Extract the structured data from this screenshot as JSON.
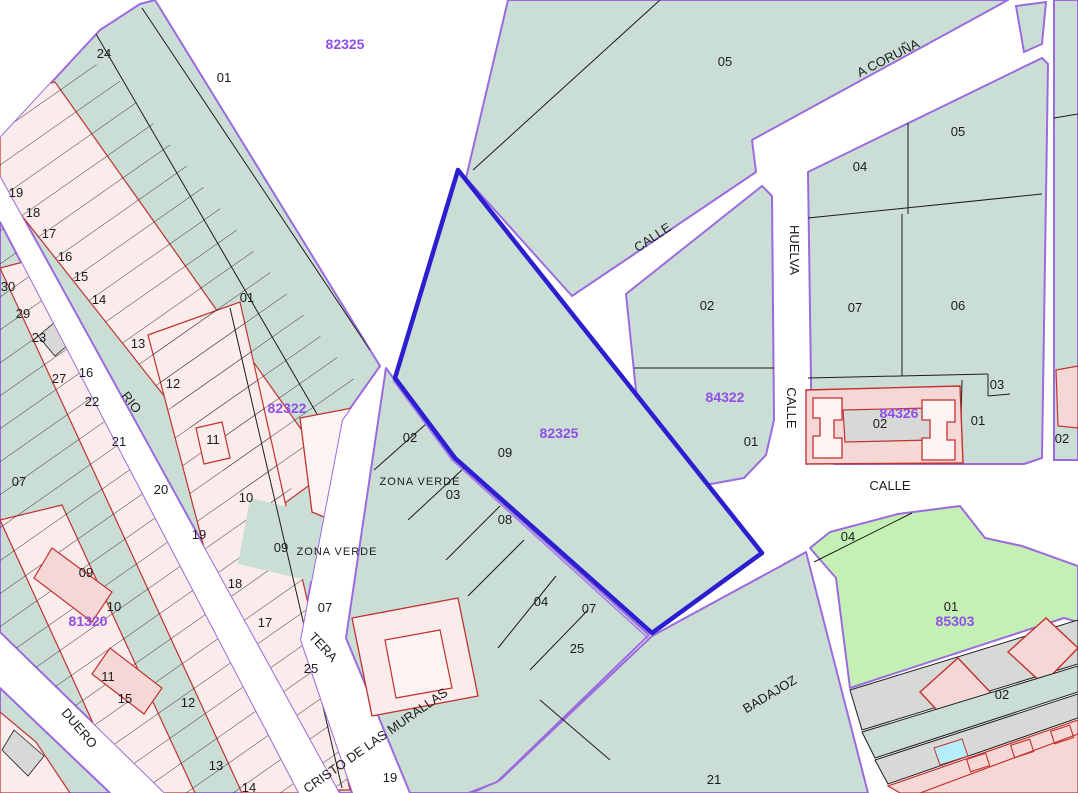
{
  "title": "Cadastral map viewer",
  "colors": {
    "street_white": "#ffffff",
    "parcel_green": "#cbded6",
    "zone_light_green": "#c5f0b5",
    "rowhouse_pink": "#faecea",
    "building_pink": "#f5d8d5",
    "courtyard_gray": "#d6d9d6",
    "pool_cyan": "#b5eefa",
    "block_border_purple": "#9b6bde",
    "selected_parcel_blue": "#2b1fd0",
    "building_red": "#c23230",
    "parcel_line_black": "#1c1c1c",
    "block_number_purple": "#8f4fe8"
  },
  "map": {
    "selected_block_number": "82325",
    "labels": [
      {
        "t": "24",
        "x": 104,
        "y": 58,
        "k": "k"
      },
      {
        "t": "01",
        "x": 224,
        "y": 82,
        "k": "k"
      },
      {
        "t": "82325",
        "x": 345,
        "y": 49,
        "k": "p"
      },
      {
        "t": "05",
        "x": 725,
        "y": 66,
        "k": "k"
      },
      {
        "t": "A CORUÑA",
        "x": 890,
        "y": 62,
        "k": "s",
        "r": -27
      },
      {
        "t": "05",
        "x": 958,
        "y": 136,
        "k": "k"
      },
      {
        "t": "04",
        "x": 860,
        "y": 171,
        "k": "k"
      },
      {
        "t": "CALLE",
        "x": 655,
        "y": 241,
        "k": "s",
        "r": -34
      },
      {
        "t": "HUELVA",
        "x": 790,
        "y": 250,
        "k": "s",
        "r": 90
      },
      {
        "t": "02",
        "x": 707,
        "y": 310,
        "k": "k"
      },
      {
        "t": "07",
        "x": 855,
        "y": 312,
        "k": "k"
      },
      {
        "t": "06",
        "x": 958,
        "y": 310,
        "k": "k"
      },
      {
        "t": "01",
        "x": 247,
        "y": 302,
        "k": "k"
      },
      {
        "t": "82322",
        "x": 287,
        "y": 413,
        "k": "p"
      },
      {
        "t": "84322",
        "x": 725,
        "y": 402,
        "k": "p"
      },
      {
        "t": "CALLE",
        "x": 787,
        "y": 408,
        "k": "s",
        "r": 90
      },
      {
        "t": "84326",
        "x": 899,
        "y": 418,
        "k": "p"
      },
      {
        "t": "02",
        "x": 880,
        "y": 428,
        "k": "k"
      },
      {
        "t": "01",
        "x": 978,
        "y": 425,
        "k": "k"
      },
      {
        "t": "03",
        "x": 997,
        "y": 389,
        "k": "k"
      },
      {
        "t": "01",
        "x": 751,
        "y": 446,
        "k": "k"
      },
      {
        "t": "02",
        "x": 1062,
        "y": 443,
        "k": "k"
      },
      {
        "t": "CALLE",
        "x": 890,
        "y": 490,
        "k": "s"
      },
      {
        "t": "02",
        "x": 410,
        "y": 442,
        "k": "k"
      },
      {
        "t": "09",
        "x": 505,
        "y": 457,
        "k": "k"
      },
      {
        "t": "82325",
        "x": 559,
        "y": 438,
        "k": "p"
      },
      {
        "t": "ZONA VERDE",
        "x": 420,
        "y": 485,
        "k": "z"
      },
      {
        "t": "03",
        "x": 453,
        "y": 499,
        "k": "k"
      },
      {
        "t": "08",
        "x": 505,
        "y": 524,
        "k": "k"
      },
      {
        "t": "ZONA VERDE",
        "x": 337,
        "y": 555,
        "k": "z"
      },
      {
        "t": "09",
        "x": 281,
        "y": 552,
        "k": "k"
      },
      {
        "t": "04",
        "x": 541,
        "y": 606,
        "k": "k"
      },
      {
        "t": "07",
        "x": 589,
        "y": 613,
        "k": "k"
      },
      {
        "t": "07",
        "x": 325,
        "y": 612,
        "k": "k"
      },
      {
        "t": "25",
        "x": 577,
        "y": 653,
        "k": "k"
      },
      {
        "t": "04",
        "x": 848,
        "y": 541,
        "k": "k"
      },
      {
        "t": "01",
        "x": 951,
        "y": 611,
        "k": "k"
      },
      {
        "t": "85303",
        "x": 955,
        "y": 626,
        "k": "p"
      },
      {
        "t": "02",
        "x": 1002,
        "y": 699,
        "k": "k"
      },
      {
        "t": "BADAJOZ",
        "x": 772,
        "y": 698,
        "k": "s",
        "r": -31
      },
      {
        "t": "21",
        "x": 714,
        "y": 784,
        "k": "k"
      },
      {
        "t": "19",
        "x": 390,
        "y": 782,
        "k": "k"
      },
      {
        "t": "CRISTO DE LAS MURALLAS",
        "x": 378,
        "y": 744,
        "k": "s",
        "r": -35
      },
      {
        "t": "TERA",
        "x": 320,
        "y": 650,
        "k": "s",
        "r": 47
      },
      {
        "t": "RIO",
        "x": 128,
        "y": 405,
        "k": "s",
        "r": 52
      },
      {
        "t": "DUERO",
        "x": 76,
        "y": 731,
        "k": "s",
        "r": 50
      },
      {
        "t": "30",
        "x": 8,
        "y": 291,
        "k": "k"
      },
      {
        "t": "29",
        "x": 23,
        "y": 318,
        "k": "k"
      },
      {
        "t": "23",
        "x": 39,
        "y": 342,
        "k": "k"
      },
      {
        "t": "27",
        "x": 59,
        "y": 383,
        "k": "k"
      },
      {
        "t": "16",
        "x": 86,
        "y": 377,
        "k": "k"
      },
      {
        "t": "22",
        "x": 92,
        "y": 406,
        "k": "k"
      },
      {
        "t": "21",
        "x": 119,
        "y": 446,
        "k": "k"
      },
      {
        "t": "13",
        "x": 138,
        "y": 348,
        "k": "k"
      },
      {
        "t": "12",
        "x": 173,
        "y": 388,
        "k": "k"
      },
      {
        "t": "11",
        "x": 213,
        "y": 444,
        "k": "k"
      },
      {
        "t": "10",
        "x": 246,
        "y": 502,
        "k": "k"
      },
      {
        "t": "20",
        "x": 161,
        "y": 494,
        "k": "k"
      },
      {
        "t": "19",
        "x": 199,
        "y": 539,
        "k": "k"
      },
      {
        "t": "09",
        "x": 86,
        "y": 577,
        "k": "k"
      },
      {
        "t": "10",
        "x": 114,
        "y": 611,
        "k": "k"
      },
      {
        "t": "81320",
        "x": 88,
        "y": 626,
        "k": "p"
      },
      {
        "t": "18",
        "x": 235,
        "y": 588,
        "k": "k"
      },
      {
        "t": "17",
        "x": 265,
        "y": 627,
        "k": "k"
      },
      {
        "t": "25",
        "x": 311,
        "y": 673,
        "k": "k"
      },
      {
        "t": "11",
        "x": 108,
        "y": 681,
        "k": "k"
      },
      {
        "t": "15",
        "x": 125,
        "y": 703,
        "k": "k"
      },
      {
        "t": "12",
        "x": 188,
        "y": 707,
        "k": "k"
      },
      {
        "t": "13",
        "x": 216,
        "y": 770,
        "k": "k"
      },
      {
        "t": "14",
        "x": 249,
        "y": 792,
        "k": "k"
      },
      {
        "t": "07",
        "x": 19,
        "y": 486,
        "k": "k"
      },
      {
        "t": "19",
        "x": 16,
        "y": 197,
        "k": "k"
      },
      {
        "t": "18",
        "x": 33,
        "y": 217,
        "k": "k"
      },
      {
        "t": "17",
        "x": 49,
        "y": 238,
        "k": "k"
      },
      {
        "t": "16",
        "x": 65,
        "y": 261,
        "k": "k"
      },
      {
        "t": "15",
        "x": 81,
        "y": 281,
        "k": "k"
      },
      {
        "t": "14",
        "x": 99,
        "y": 304,
        "k": "k"
      }
    ]
  }
}
